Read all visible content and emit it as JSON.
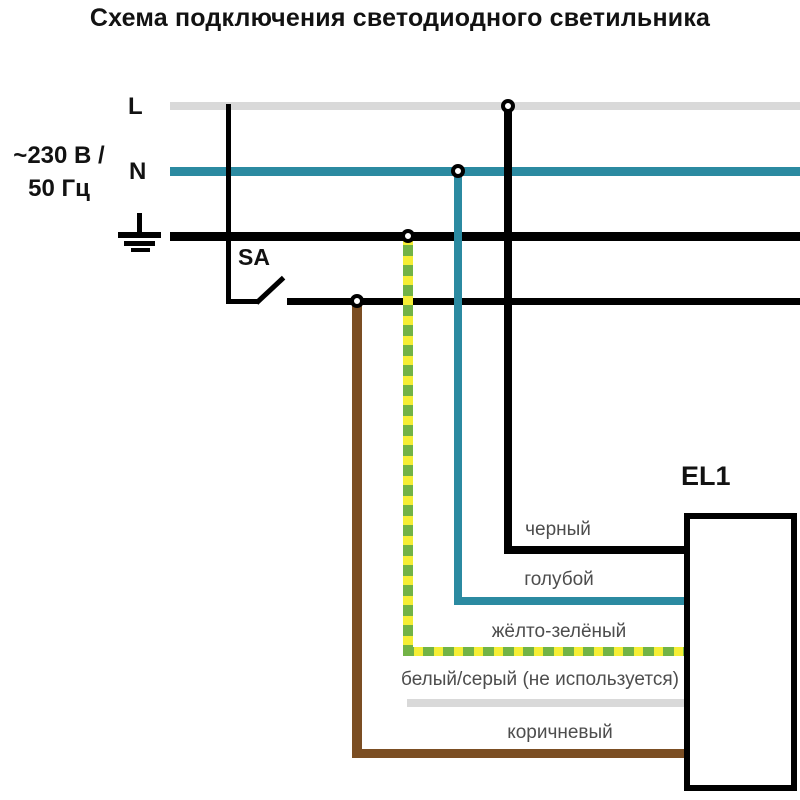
{
  "title": "Схема подключения светодиодного светильника",
  "supply": {
    "voltage_line1": "~230 В /",
    "voltage_line2": "50 Гц",
    "phase_label": "L",
    "neutral_label": "N"
  },
  "switch": {
    "label": "SA"
  },
  "luminaire": {
    "label": "EL1"
  },
  "wires": {
    "black_label": "черный",
    "blue_label": "голубой",
    "yellow_green_label": "жёлто-зелёный",
    "white_gray_label": "белый/серый (не используется)",
    "brown_label": "коричневый"
  },
  "colors": {
    "neutral-blue": "#2b8aa1",
    "line-gray": "#d9d9d9",
    "brown": "#7b4e23",
    "yg-yellow": "#f5ee35",
    "yg-green": "#72b346",
    "wire-black": "#000000",
    "label-text": "#4d4d4d"
  }
}
